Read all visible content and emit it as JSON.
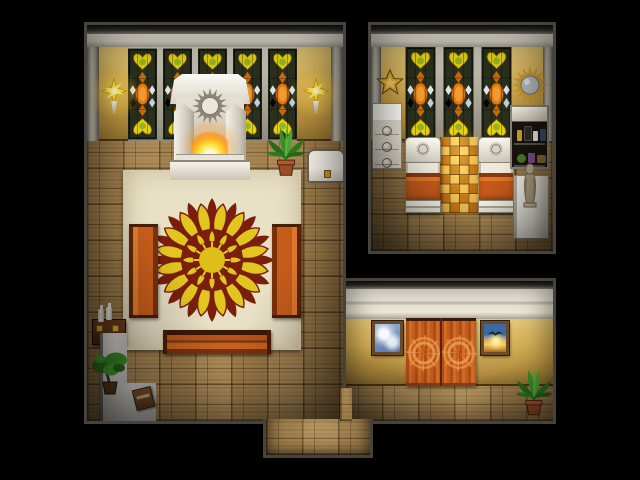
{
  "palette": {
    "background": "#000000",
    "border-dark": "#46423c",
    "floor-tan": "#a07e4e",
    "wall-gold": "#cda74c",
    "cornice-white": "#ece8da",
    "window-frame": "#202416",
    "glass-yellow": "#e4d313",
    "glass-orange": "#e07c16",
    "carpet-cream": "#e9e1c6",
    "mandala-red": "#7a1f0e",
    "mandala-yellow": "#e3c520",
    "bench-orange": "#c65d1c",
    "curtain-orange": "#c25c1c",
    "gold-tile": "#d89020",
    "plant-green": "#3c8f28",
    "fire-yellow": "#ffe23a",
    "statue-tan": "#b8a88c"
  },
  "scene": {
    "viewport_label": "top-down RPG interior map, sunlit temple residence",
    "rooms": {
      "sanctuary": {
        "label": "main sanctuary hall with sun-mandala rug",
        "window_count": 5,
        "objects": {
          "altar": "altar with sun medallion and sacred flame",
          "rug": "cream rug with red and yellow sun mandala",
          "bench_left": "orange bench (west)",
          "bench_right": "orange bench (east)",
          "bench_bottom": "orange bench (south)",
          "sconce": "wall torch sconce with yellow starburst glow",
          "palm": "potted palm",
          "chest": "white chest with gold clasp",
          "table": "offering table with white bottles",
          "bonsai": "bonsai plant in pot",
          "book": "dropped brown book",
          "ledge": "light stone ledge"
        }
      },
      "bedroom": {
        "label": "bedroom with twin beds and gold mosaic runner",
        "window_count": 3,
        "objects": {
          "star": "gold star wall ornament",
          "mirror": "sunburst wall mirror",
          "dresser": "white dresser with round medallions",
          "shelf": "black shelf stocked with jars and potions",
          "bed_left": "twin bed with orange blanket (west)",
          "bed_right": "twin bed with orange blanket (east)",
          "mosaic": "gold mosaic tile runner",
          "statue": "statue on white pedestal"
        }
      },
      "hallway": {
        "label": "south hallway",
        "objects": {
          "painting_clouds": "framed painting of clouds",
          "painting_sunset": "framed painting of sunset with bird",
          "curtains": "orange double door curtains with sun emblems",
          "palm": "potted palm"
        }
      },
      "exit": {
        "label": "south exit passage"
      }
    }
  }
}
